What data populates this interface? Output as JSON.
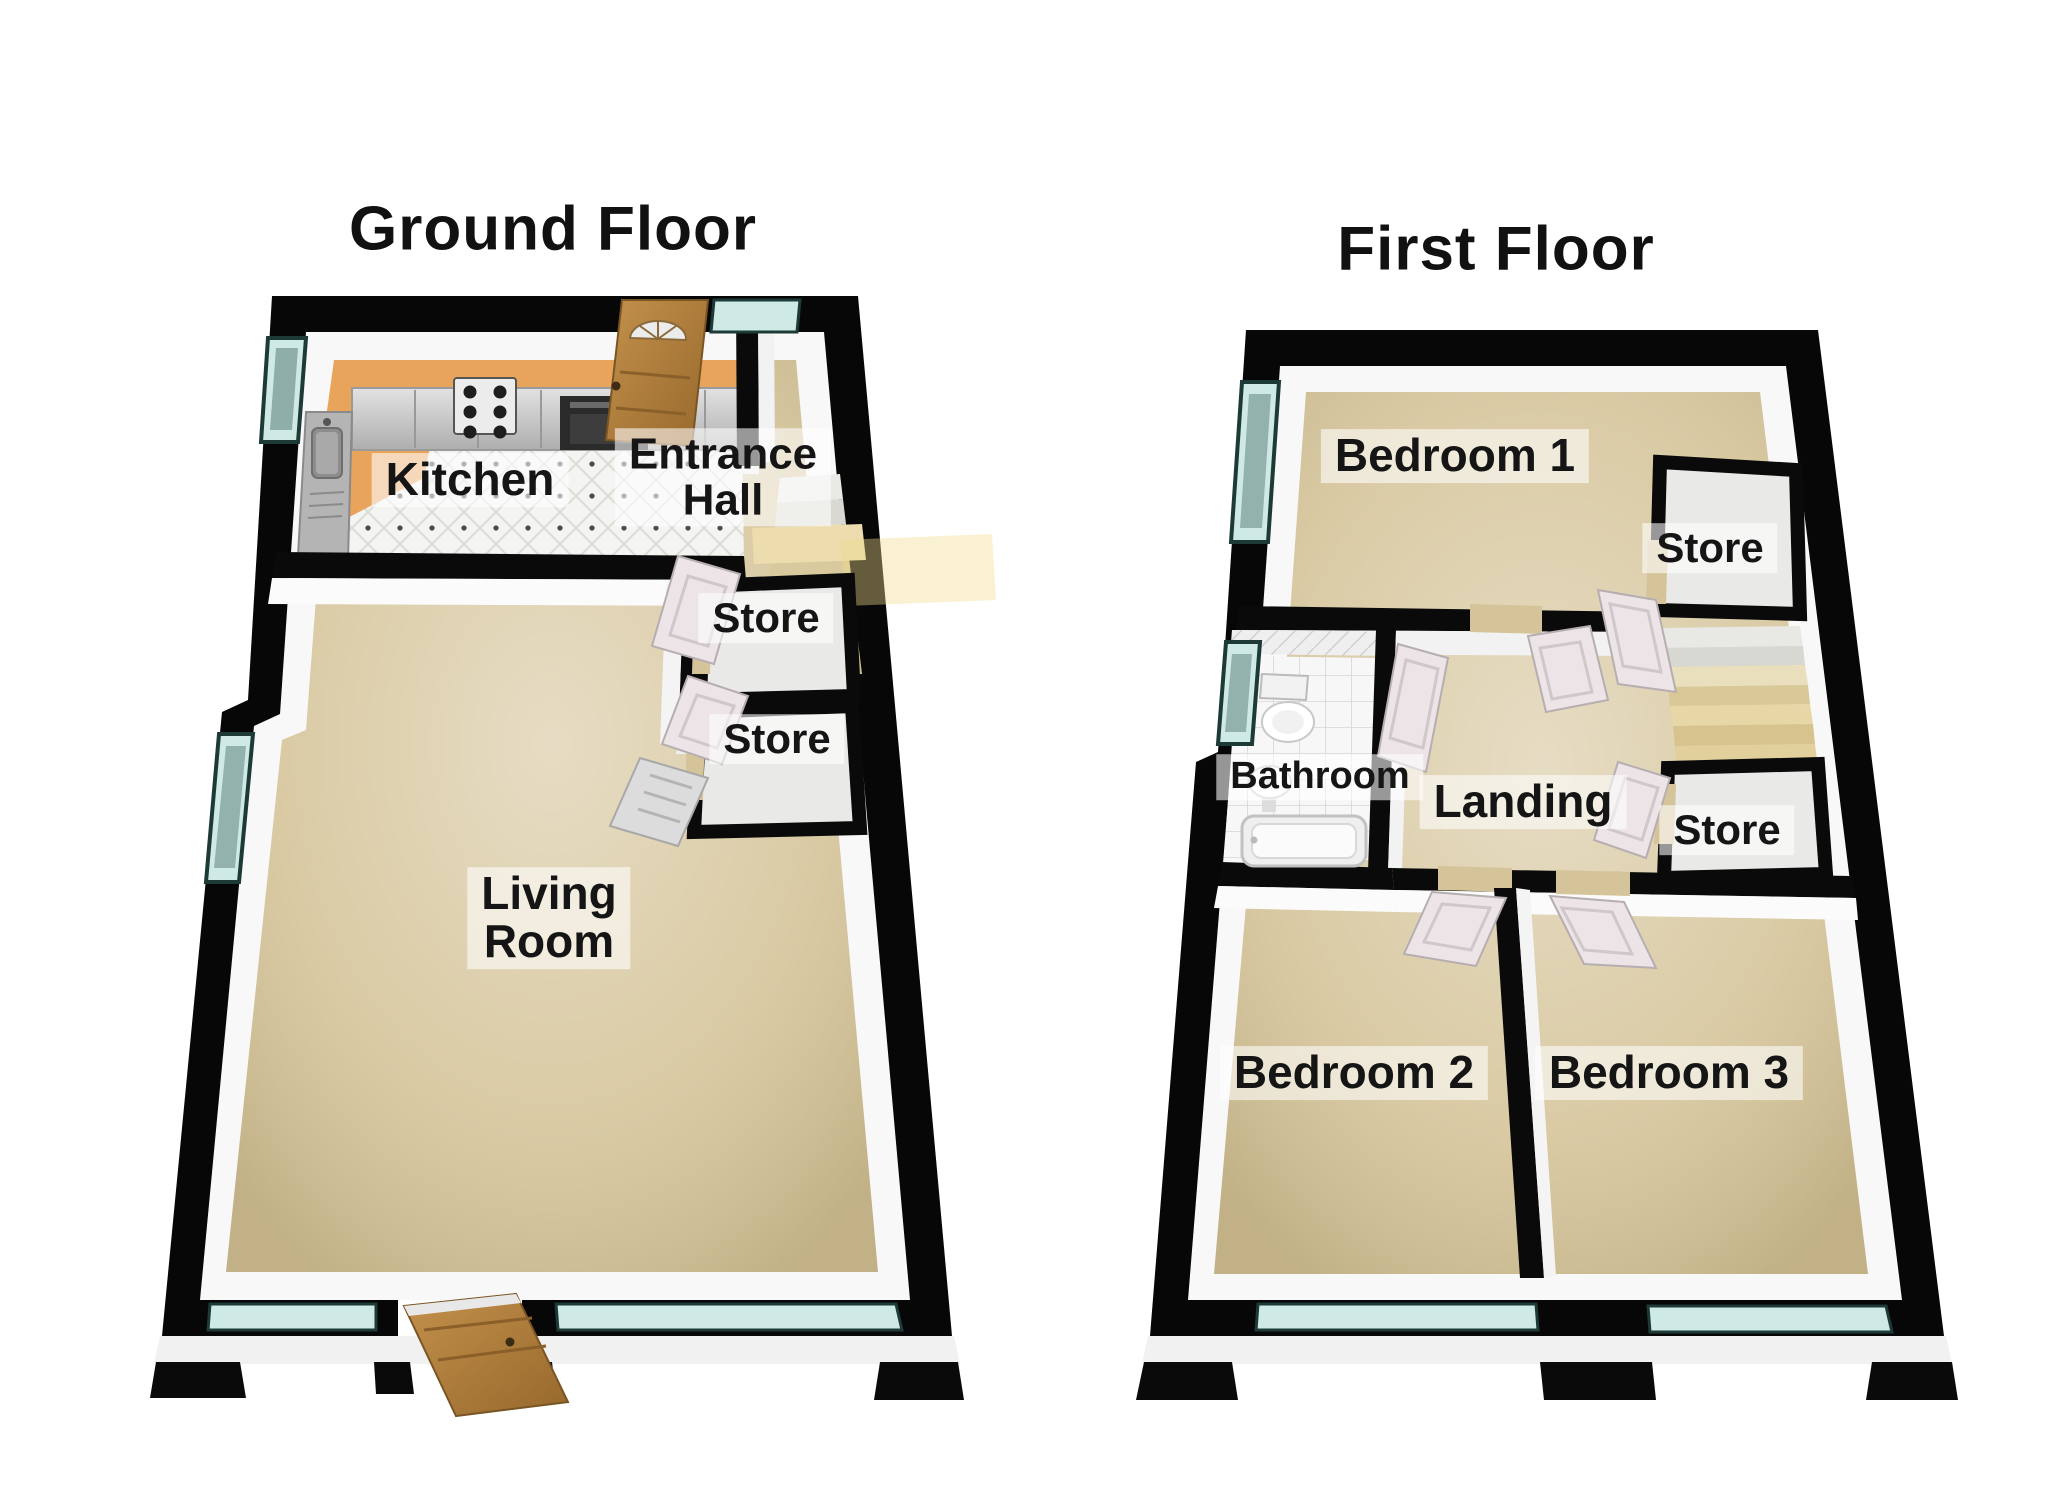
{
  "colors": {
    "background": "#ffffff",
    "wall": "#070707",
    "inner_wall": "#f8f8f8",
    "carpet": "#d5c499",
    "kitchen_floor": "#e9a45c",
    "kitchen_tile": "#f4f4f2",
    "bath_tile": "#f7f7f7",
    "window_glass": "#cfe9e4",
    "window_pane_dark": "#6d8d89",
    "window_frame": "#1d3a37",
    "wood_door": "#b5823f",
    "interior_door": "#ece4e6",
    "stairs": "#e6d6a2",
    "store_floor": "#e9e9e7",
    "label_text": "#151515",
    "label_background": "rgba(255,255,255,0.58)"
  },
  "floors": [
    {
      "title": "Ground Floor",
      "rooms": [
        {
          "name": "kitchen",
          "lines": [
            "Kitchen"
          ]
        },
        {
          "name": "entrance-hall",
          "lines": [
            "Entrance",
            "Hall"
          ]
        },
        {
          "name": "store-1",
          "lines": [
            "Store"
          ]
        },
        {
          "name": "store-2",
          "lines": [
            "Store"
          ]
        },
        {
          "name": "living-room",
          "lines": [
            "Living",
            "Room"
          ]
        }
      ]
    },
    {
      "title": "First Floor",
      "rooms": [
        {
          "name": "bedroom-1",
          "lines": [
            "Bedroom 1"
          ]
        },
        {
          "name": "store-top",
          "lines": [
            "Store"
          ]
        },
        {
          "name": "bathroom",
          "lines": [
            "Bathroom"
          ]
        },
        {
          "name": "landing",
          "lines": [
            "Landing"
          ]
        },
        {
          "name": "store-middle",
          "lines": [
            "Store"
          ]
        },
        {
          "name": "bedroom-2",
          "lines": [
            "Bedroom 2"
          ]
        },
        {
          "name": "bedroom-3",
          "lines": [
            "Bedroom 3"
          ]
        }
      ]
    }
  ]
}
